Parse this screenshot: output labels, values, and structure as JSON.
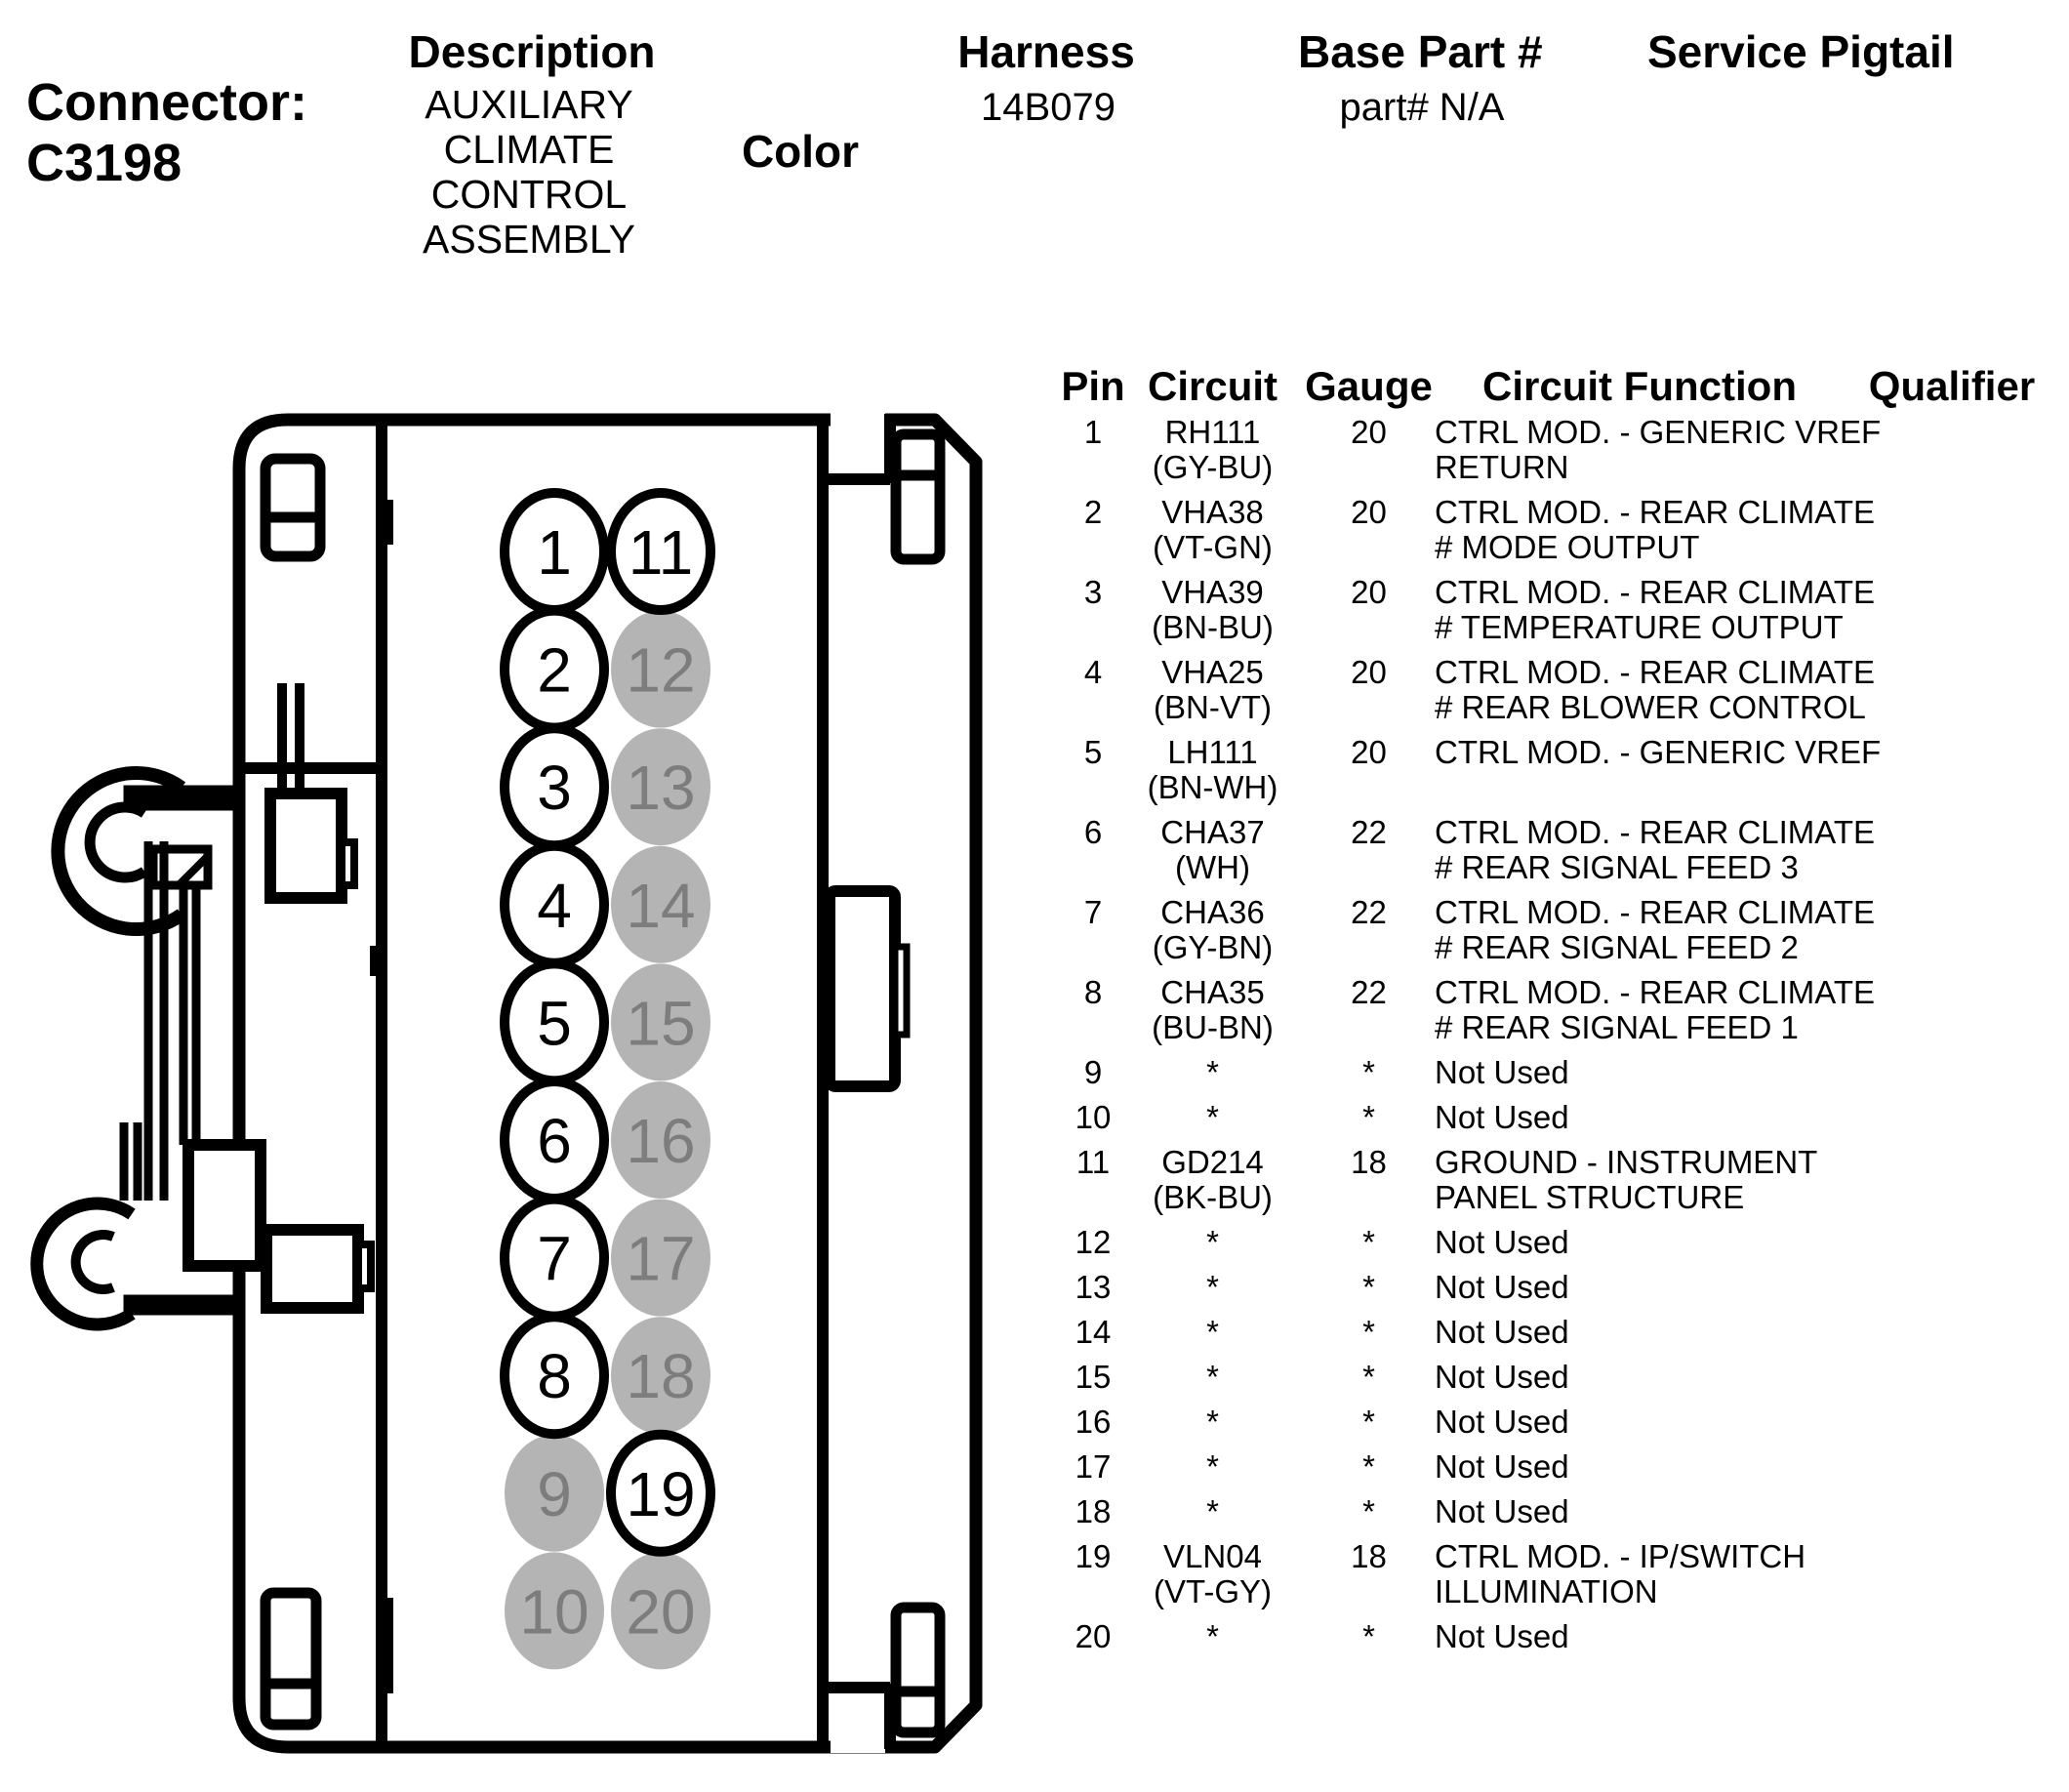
{
  "header": {
    "connector_label": "Connector:",
    "connector_id": "C3198",
    "description": {
      "label": "Description",
      "lines": [
        "AUXILIARY",
        "CLIMATE",
        "CONTROL",
        "ASSEMBLY"
      ]
    },
    "color": {
      "label": "Color",
      "value": ""
    },
    "harness": {
      "label": "Harness",
      "value": "14B079"
    },
    "base_part": {
      "label": "Base Part #",
      "value": "part# N/A"
    },
    "service_pigtail": {
      "label": "Service Pigtail",
      "value": ""
    }
  },
  "pin_table": {
    "headers": {
      "pin": "Pin",
      "circuit": "Circuit",
      "gauge": "Gauge",
      "circuit_function": "Circuit Function",
      "qualifier": "Qualifier"
    },
    "rows": [
      {
        "pin": "1",
        "circuit_lines": [
          "RH111",
          "(GY-BU)"
        ],
        "gauge": "20",
        "function_lines": [
          "CTRL MOD. - GENERIC VREF",
          "RETURN"
        ],
        "qualifier": ""
      },
      {
        "pin": "2",
        "circuit_lines": [
          "VHA38",
          "(VT-GN)"
        ],
        "gauge": "20",
        "function_lines": [
          "CTRL MOD. - REAR CLIMATE",
          "# MODE OUTPUT"
        ],
        "qualifier": ""
      },
      {
        "pin": "3",
        "circuit_lines": [
          "VHA39",
          "(BN-BU)"
        ],
        "gauge": "20",
        "function_lines": [
          "CTRL MOD. - REAR CLIMATE",
          "# TEMPERATURE OUTPUT"
        ],
        "qualifier": ""
      },
      {
        "pin": "4",
        "circuit_lines": [
          "VHA25",
          "(BN-VT)"
        ],
        "gauge": "20",
        "function_lines": [
          "CTRL MOD. - REAR CLIMATE",
          "# REAR BLOWER CONTROL"
        ],
        "qualifier": ""
      },
      {
        "pin": "5",
        "circuit_lines": [
          "LH111",
          "(BN-WH)"
        ],
        "gauge": "20",
        "function_lines": [
          "CTRL MOD. - GENERIC VREF"
        ],
        "qualifier": ""
      },
      {
        "pin": "6",
        "circuit_lines": [
          "CHA37",
          "(WH)"
        ],
        "gauge": "22",
        "function_lines": [
          "CTRL MOD. - REAR CLIMATE",
          "# REAR SIGNAL FEED 3"
        ],
        "qualifier": ""
      },
      {
        "pin": "7",
        "circuit_lines": [
          "CHA36",
          "(GY-BN)"
        ],
        "gauge": "22",
        "function_lines": [
          "CTRL MOD. - REAR CLIMATE",
          "# REAR SIGNAL FEED 2"
        ],
        "qualifier": ""
      },
      {
        "pin": "8",
        "circuit_lines": [
          "CHA35",
          "(BU-BN)"
        ],
        "gauge": "22",
        "function_lines": [
          "CTRL MOD. - REAR CLIMATE",
          "# REAR SIGNAL FEED 1"
        ],
        "qualifier": ""
      },
      {
        "pin": "9",
        "circuit_lines": [
          "*"
        ],
        "gauge": "*",
        "function_lines": [
          "Not Used"
        ],
        "qualifier": ""
      },
      {
        "pin": "10",
        "circuit_lines": [
          "*"
        ],
        "gauge": "*",
        "function_lines": [
          "Not Used"
        ],
        "qualifier": ""
      },
      {
        "pin": "11",
        "circuit_lines": [
          "GD214",
          "(BK-BU)"
        ],
        "gauge": "18",
        "function_lines": [
          "GROUND - INSTRUMENT",
          "PANEL STRUCTURE"
        ],
        "qualifier": ""
      },
      {
        "pin": "12",
        "circuit_lines": [
          "*"
        ],
        "gauge": "*",
        "function_lines": [
          "Not Used"
        ],
        "qualifier": ""
      },
      {
        "pin": "13",
        "circuit_lines": [
          "*"
        ],
        "gauge": "*",
        "function_lines": [
          "Not Used"
        ],
        "qualifier": ""
      },
      {
        "pin": "14",
        "circuit_lines": [
          "*"
        ],
        "gauge": "*",
        "function_lines": [
          "Not Used"
        ],
        "qualifier": ""
      },
      {
        "pin": "15",
        "circuit_lines": [
          "*"
        ],
        "gauge": "*",
        "function_lines": [
          "Not Used"
        ],
        "qualifier": ""
      },
      {
        "pin": "16",
        "circuit_lines": [
          "*"
        ],
        "gauge": "*",
        "function_lines": [
          "Not Used"
        ],
        "qualifier": ""
      },
      {
        "pin": "17",
        "circuit_lines": [
          "*"
        ],
        "gauge": "*",
        "function_lines": [
          "Not Used"
        ],
        "qualifier": ""
      },
      {
        "pin": "18",
        "circuit_lines": [
          "*"
        ],
        "gauge": "*",
        "function_lines": [
          "Not Used"
        ],
        "qualifier": ""
      },
      {
        "pin": "19",
        "circuit_lines": [
          "VLN04",
          "(VT-GY)"
        ],
        "gauge": "18",
        "function_lines": [
          "CTRL MOD. - IP/SWITCH",
          "ILLUMINATION"
        ],
        "qualifier": ""
      },
      {
        "pin": "20",
        "circuit_lines": [
          "*"
        ],
        "gauge": "*",
        "function_lines": [
          "Not Used"
        ],
        "qualifier": ""
      }
    ]
  },
  "connector_diagram": {
    "pins": [
      {
        "number": "1",
        "used": true
      },
      {
        "number": "2",
        "used": true
      },
      {
        "number": "3",
        "used": true
      },
      {
        "number": "4",
        "used": true
      },
      {
        "number": "5",
        "used": true
      },
      {
        "number": "6",
        "used": true
      },
      {
        "number": "7",
        "used": true
      },
      {
        "number": "8",
        "used": true
      },
      {
        "number": "9",
        "used": false
      },
      {
        "number": "10",
        "used": false
      },
      {
        "number": "11",
        "used": true
      },
      {
        "number": "12",
        "used": false
      },
      {
        "number": "13",
        "used": false
      },
      {
        "number": "14",
        "used": false
      },
      {
        "number": "15",
        "used": false
      },
      {
        "number": "16",
        "used": false
      },
      {
        "number": "17",
        "used": false
      },
      {
        "number": "18",
        "used": false
      },
      {
        "number": "19",
        "used": true
      },
      {
        "number": "20",
        "used": false
      }
    ],
    "colors": {
      "outline": "#000000",
      "used_pin_fill": "#ffffff",
      "used_pin_text": "#000000",
      "unused_pin_fill": "#b4b4b4",
      "unused_pin_text": "#7d7d7d"
    }
  }
}
